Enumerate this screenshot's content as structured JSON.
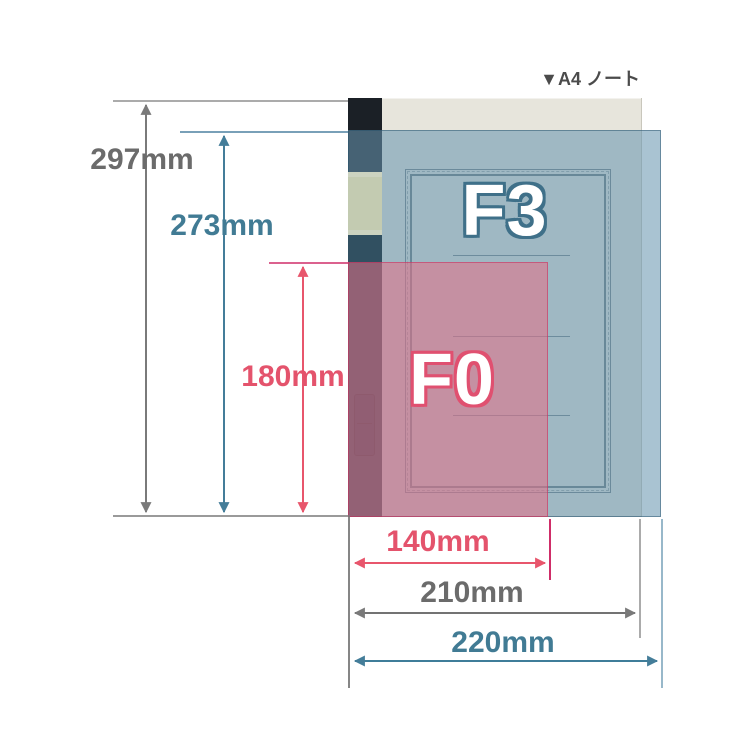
{
  "annotation": {
    "product_label": "▼A4 ノート"
  },
  "overlays": {
    "f3_label": "F3",
    "f0_label": "F0",
    "f3_fill": "#6895af",
    "f0_fill": "#e36f87"
  },
  "measurements": {
    "a4_height": "297mm",
    "f3_height": "273mm",
    "f0_height": "180mm",
    "f0_width": "140mm",
    "a4_width": "210mm",
    "f3_width": "220mm"
  },
  "colors": {
    "a4_dimension_text": "#6b6b6b",
    "f3_dimension_text": "#417b94",
    "f0_dimension_text": "#e4536c",
    "notebook_cover": "#e7e5dc",
    "notebook_spine": "#1b2026",
    "spine_label_band": "#c3cbb1",
    "spine_tape_band": "#315061"
  }
}
